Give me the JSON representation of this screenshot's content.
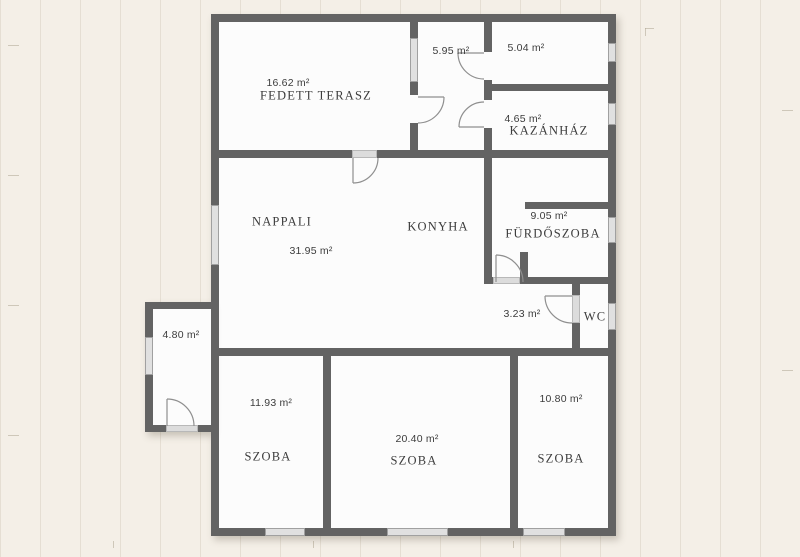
{
  "plan": {
    "type": "floor-plan",
    "unit": "m²",
    "colors": {
      "wall": "#636363",
      "window_fill": "#e0e0e0",
      "floor": "#fcfcfc",
      "background": "#f4efe7",
      "door_stroke": "#8f8f8f",
      "label_text": "#3c3c3c"
    }
  },
  "rooms": [
    {
      "name": "FEDETT TERASZ",
      "area": "16.62 m²"
    },
    {
      "name": "",
      "area": "5.95 m²"
    },
    {
      "name": "",
      "area": "5.04 m²"
    },
    {
      "name": "KAZÁNHÁZ",
      "area": "4.65 m²"
    },
    {
      "name": "NAPPALI",
      "area": "31.95 m²"
    },
    {
      "name": "KONYHA",
      "area": ""
    },
    {
      "name": "FÜRDŐSZOBA",
      "area": "9.05 m²"
    },
    {
      "name": "",
      "area": "3.23 m²"
    },
    {
      "name": "WC",
      "area": ""
    },
    {
      "name": "",
      "area": "4.80 m²"
    },
    {
      "name": "SZOBA",
      "area": "11.93 m²"
    },
    {
      "name": "SZOBA",
      "area": "20.40 m²"
    },
    {
      "name": "SZOBA",
      "area": "10.80 m²"
    }
  ]
}
